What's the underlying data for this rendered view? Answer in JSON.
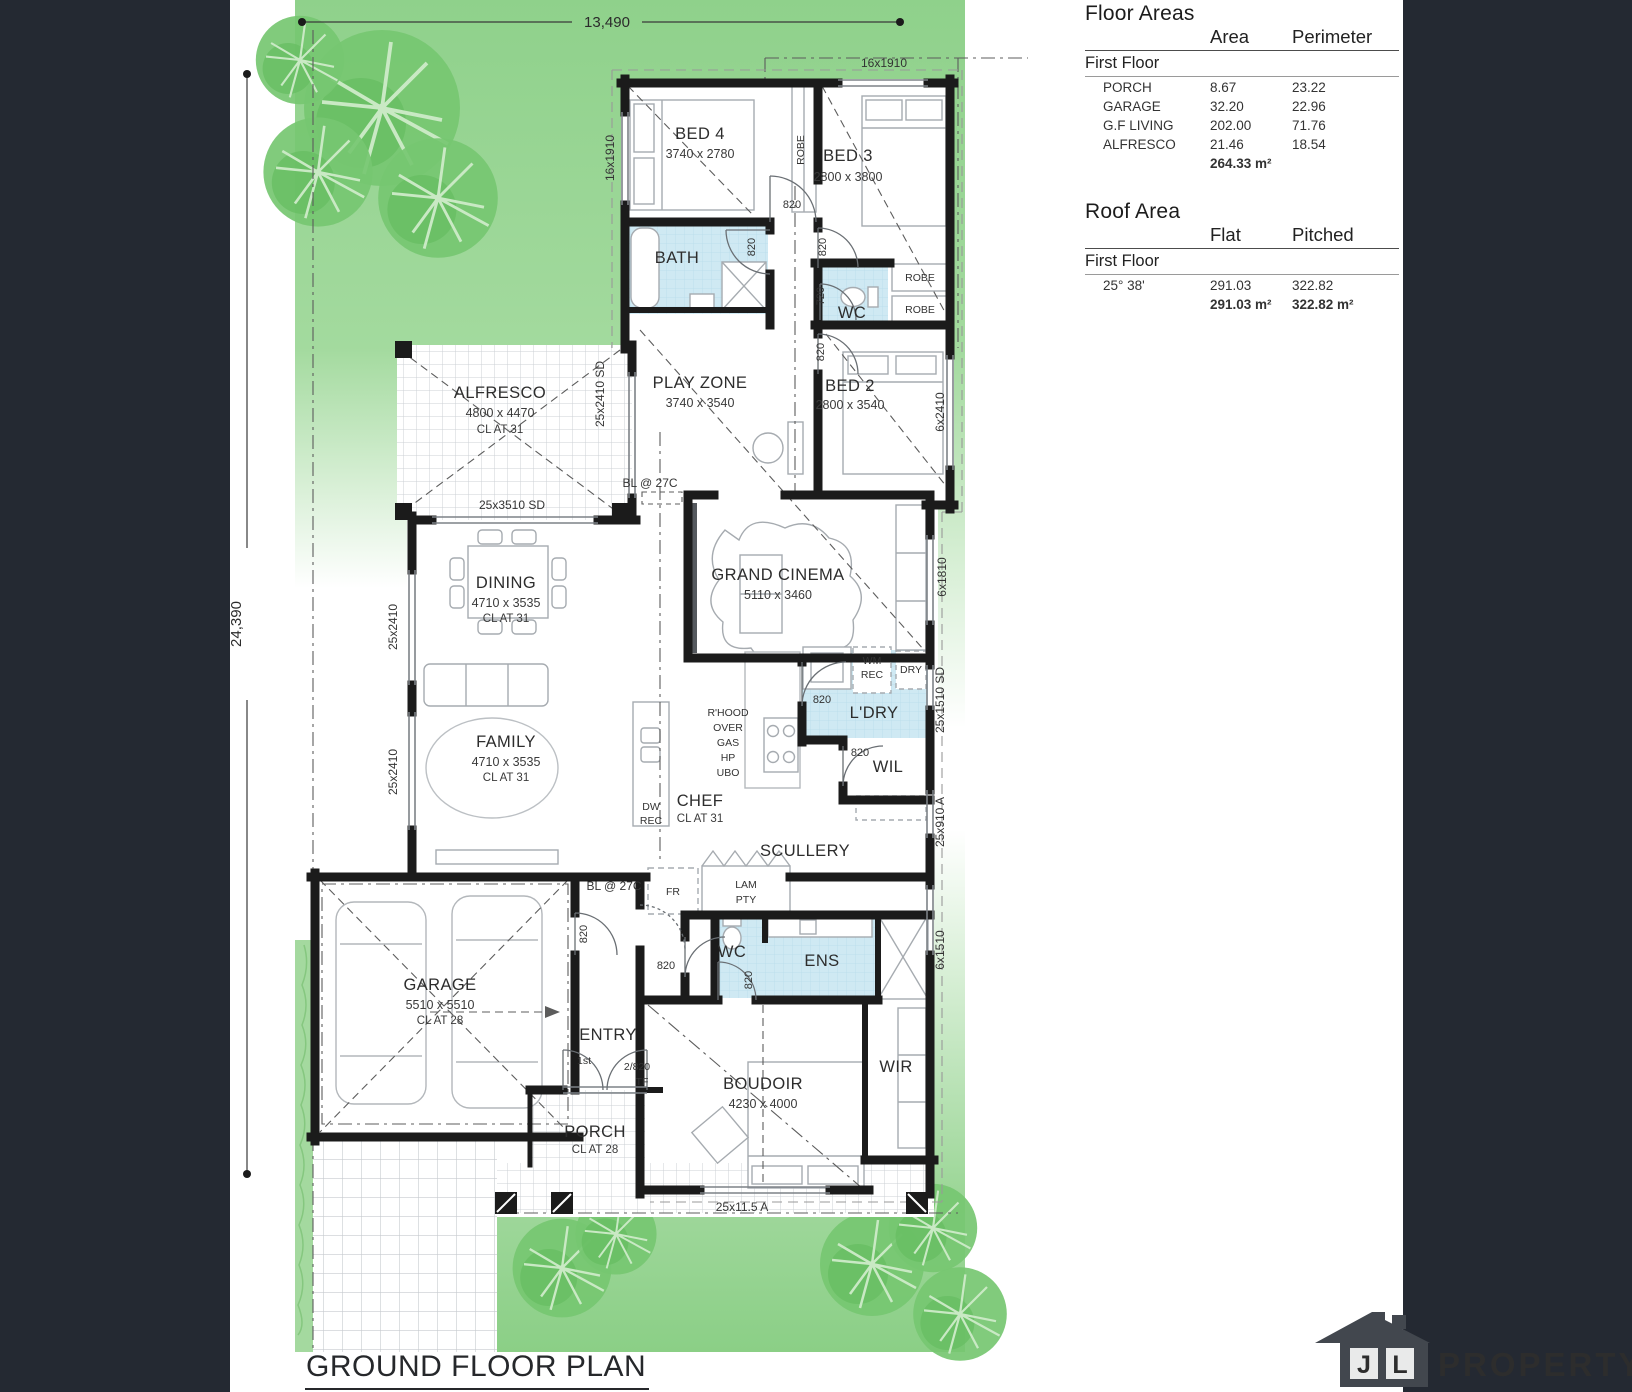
{
  "colors": {
    "lawn": "#93d28e",
    "lawn_light": "#dcf1d8",
    "tree": "#74c56f",
    "wet_area": "#cfe9f3",
    "wall": "#1c1c1c",
    "sidebar": "#242932",
    "logo_grey": "#42474e"
  },
  "side_panel": {
    "floor_areas": {
      "heading": "Floor Areas",
      "columns": {
        "area": "Area",
        "perimeter": "Perimeter"
      },
      "section": "First Floor",
      "rows": [
        {
          "name": "PORCH",
          "area": "8.67",
          "perimeter": "23.22"
        },
        {
          "name": "GARAGE",
          "area": "32.20",
          "perimeter": "22.96"
        },
        {
          "name": "G.F LIVING",
          "area": "202.00",
          "perimeter": "71.76"
        },
        {
          "name": "ALFRESCO",
          "area": "21.46",
          "perimeter": "18.54"
        }
      ],
      "total_area": "264.33 m²"
    },
    "roof_area": {
      "heading": "Roof Area",
      "columns": {
        "flat": "Flat",
        "pitched": "Pitched"
      },
      "section": "First Floor",
      "row": {
        "pitch": "25°  38'",
        "flat": "291.03",
        "pitched": "322.82"
      },
      "totals": {
        "flat": "291.03 m²",
        "pitched": "322.82 m²"
      }
    }
  },
  "plan": {
    "title": "GROUND FLOOR PLAN",
    "dimensions": {
      "lot_width": "13,490",
      "lot_depth": "24,390"
    },
    "rooms": {
      "bed4": {
        "name": "BED 4",
        "size": "3740 x 2780"
      },
      "bed3": {
        "name": "BED 3",
        "size": "2800 x 3800"
      },
      "bed2": {
        "name": "BED 2",
        "size": "2800 x 3540"
      },
      "bath": {
        "name": "BATH"
      },
      "wc": {
        "name": "WC"
      },
      "play_zone": {
        "name": "PLAY ZONE",
        "size": "3740 x 3540"
      },
      "alfresco": {
        "name": "ALFRESCO",
        "size": "4800 x 4470",
        "cl": "CL AT 31"
      },
      "grand_cinema": {
        "name": "GRAND CINEMA",
        "size": "5110 x 3460"
      },
      "dining": {
        "name": "DINING",
        "size": "4710 x 3535",
        "cl": "CL AT 31"
      },
      "family": {
        "name": "FAMILY",
        "size": "4710 x 3535",
        "cl": "CL AT 31"
      },
      "laundry": {
        "name": "L'DRY"
      },
      "wil": {
        "name": "WIL"
      },
      "chef": {
        "name": "CHEF",
        "cl": "CL AT 31"
      },
      "scullery": {
        "name": "SCULLERY"
      },
      "garage": {
        "name": "GARAGE",
        "size": "5510 x 5510",
        "cl": "CL AT 28"
      },
      "entry": {
        "name": "ENTRY"
      },
      "ens": {
        "name": "ENS"
      },
      "boudoir": {
        "name": "BOUDOIR",
        "size": "4230 x 4000"
      },
      "wir": {
        "name": "WIR"
      },
      "porch": {
        "name": "PORCH",
        "cl": "CL AT 28"
      }
    },
    "doors": {
      "d820": "820",
      "d720": "720",
      "d2820": "2/820",
      "tf": "TF",
      "first": "1st"
    },
    "windows": {
      "w16x1910": "16x1910",
      "w6x2410": "6x2410",
      "w25x2410sd": "25x2410 SD",
      "w25x3510sd": "25x3510 SD",
      "w25x2410": "25x2410",
      "w6x1810": "6x1810",
      "w25x1510sd": "25x1510 SD",
      "w25x910a": "25x910 A",
      "w6x1510": "6x1510",
      "w25x115a": "25x11.5 A"
    },
    "notes": {
      "bl27c": "BL @ 27C",
      "rhood": [
        "R'HOOD",
        "OVER",
        "GAS",
        "HP",
        "UBO"
      ],
      "wm": "WM",
      "rec": "REC",
      "dry": "DRY",
      "dw": "DW",
      "fr": "FR",
      "lam": "LAM",
      "pty": "PTY",
      "robe": "ROBE"
    }
  },
  "logo": {
    "letter_j": "J",
    "letter_l": "L",
    "brand": "PROPERTY"
  }
}
